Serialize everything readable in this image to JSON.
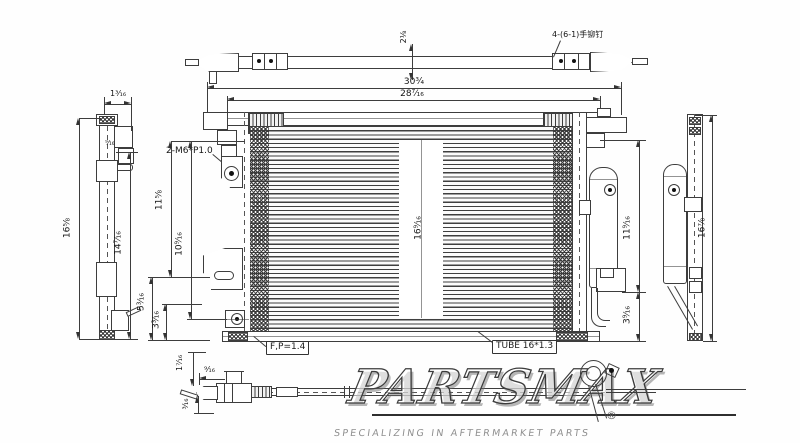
{
  "notes": {
    "rivet": "4-(6-1)手铆钉",
    "thread": "2-M6*P1.0",
    "fin_pitch": "F,P=1.4",
    "tube": "TUBE 16*1.3"
  },
  "dims": {
    "top_width": "30¾",
    "core_width": "28⁷⁄₁₆",
    "top_depth": "2⅛",
    "left_height": "16⅝",
    "left_top": "1³⁄₁₆",
    "left_stud": "⁹⁄₁₆",
    "left_span": "14⁷⁄₁₆",
    "mount_upper": "11⅝",
    "mount_lower": "10⁹⁄₁₆",
    "foot_a": "5³⁄₁₆",
    "foot_b": "3³⁄₁₆",
    "core_height": "16⁹⁄₁₆",
    "drier_span": "11⁹⁄₁₆",
    "drier_foot": "3⁹⁄₁₆",
    "right_height": "16⅞",
    "pipe_a": "1⁷⁄₁₆",
    "pipe_b": "⁹⁄₁₆",
    "pipe_c": "³⁄₁₆"
  },
  "watermark": {
    "brand": "PARTSMAX",
    "registered": "®",
    "tagline": "SPECIALIZING IN AFTERMARKET PARTS"
  }
}
